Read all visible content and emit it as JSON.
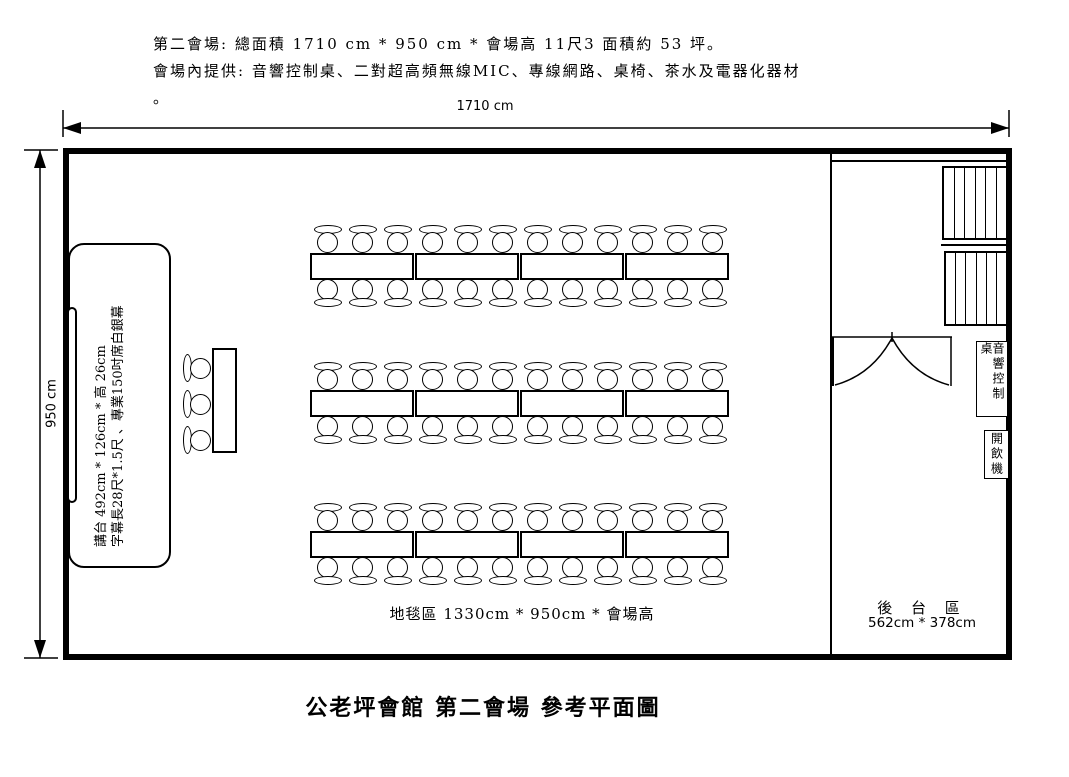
{
  "header": {
    "line1": "第二會場: 總面積 1710 cm * 950 cm * 會場高 11尺3  面積約 53 坪。",
    "line2": "會場內提供: 音響控制桌、二對超高頻無線MIC、專線網路、桌椅、茶水及電器化器材",
    "line3": "。"
  },
  "dimensions": {
    "width_label": "1710 cm",
    "height_label": "950 cm"
  },
  "stage": {
    "line1": "講台 492cm * 126cm * 高 26cm",
    "line2": "字幕長28尺*1.5尺 、專業150吋席白銀幕"
  },
  "carpet_label": "地毯區 1330cm * 950cm *  會場高",
  "backstage": {
    "name": "後 台 區",
    "size": "562cm * 378cm",
    "sound_desk_label": "音響控制桌",
    "water_dispenser_label": "開飲機"
  },
  "furniture": {
    "row_count": 3,
    "tables_per_row": 4,
    "chairs_per_table_side": 3,
    "head_table_chairs": 3,
    "storage_rack_count": 2,
    "storage_rack_slots": 6
  },
  "colors": {
    "ink": "#000000",
    "background": "#ffffff"
  },
  "title": "公老坪會館  第二會場  參考平面圖"
}
